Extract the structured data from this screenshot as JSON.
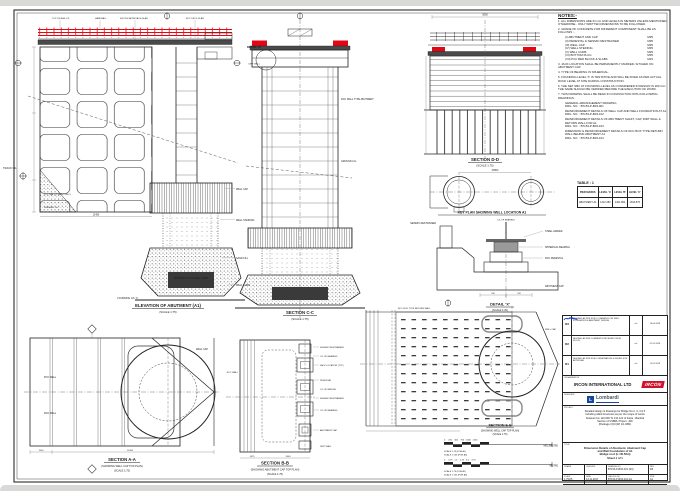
{
  "colors": {
    "accent_red": "#e30613",
    "ircon_red": "#d0112b",
    "lombardi_blue": "#16489c",
    "signature_blue": "#2743c7",
    "line": "#1b1b1b"
  },
  "elevation": {
    "label": "ELEVATION OF ABUTMENT (A1)",
    "scale": "(SCALE 1:75)",
    "top_callouts": [
      "TOP OF RAIL LVL",
      "HANDRAIL",
      "600 THK APPROACH SLAB",
      "RCC DECK SLAB"
    ],
    "side_callouts": [
      "WELL CAP",
      "WELL STEINING",
      "SAND FILL",
      "WELL CURB"
    ],
    "plug_label": "BOTTOM PLUG IN WELL CURB",
    "founding_label": "FOUNDING LVL 'X'",
    "track_label": "TRACK C/L",
    "pcc_label": "PCC WALL (PLAIN CONC.)",
    "fgl_label": "FINISHED G.L.",
    "dim_bottom": "11450"
  },
  "section_c": {
    "label": "SECTION C-C",
    "scale": "(SCALE 1:75)",
    "detail_ref": "DETAIL-'X'",
    "callouts": [
      "RCC WALL TYPE ABUTMENT",
      "GROUND LVL",
      "DIRT WALL"
    ]
  },
  "section_d": {
    "label": "SECTION D-D",
    "scale": "(SCALE 1:75)",
    "dim_top": "5600"
  },
  "key_plan": {
    "label": "KEY PLAN SHOWING WELL LOCATION A1",
    "dim": "40500"
  },
  "detail_x": {
    "label": "DETAIL 'X'",
    "scale": "(SCALE 1:20)",
    "cl": "C/L OF BEARING",
    "girder": "STEEL GIRDER",
    "bearing": "SPHERICAL BEARING",
    "restrainer": "SEISMIC RESTRAINER",
    "pedestal": "RCC PEDESTAL",
    "cap": "ABUTMENT CAP",
    "dims": [
      "700",
      "700"
    ]
  },
  "notes": {
    "title": "NOTES:-",
    "n1": "1.  ALL DIMENSIONS ARE IN mm AND LEVELS IN METERS UNLESS MENTIONED OTHERWISE - ONLY WRITTEN DIMENSIONS TO BE FOLLOWED.",
    "n2": "2.  GRADE OF CONCRETE FOR DIFFERENT COMPONENT SHALL BE AS FOLLOWS :-",
    "grades": [
      [
        "(I) ABUTMENT AND CAP",
        "M35"
      ],
      [
        "(II) PEDESTAL & SEISMIC RESTRAINER",
        "M35"
      ],
      [
        "(III) WELL CAP",
        "M35"
      ],
      [
        "(IV) WELL STEINING",
        "M35"
      ],
      [
        "(V) WELL CURB",
        "M35"
      ],
      [
        "(VI) BOTTOM PLUG",
        "M35"
      ],
      [
        "(VII) PCC BED BLOCK & SLABS",
        "M15"
      ]
    ],
    "n3": "3.  JACK LOCATION SHALL BE PERMANENTLY MARKED / ETCHED ON ABUTMENT CAP.",
    "n4": "4.  TYPE OF BEARING IS SPHERICAL.",
    "n5": "5.  FOUNDING LEVEL 'X' IS TENTATIVE AND WILL BE FIXED AS PER ACTUAL ROCK LEVEL AT SITE DURING CONSTRUCTION.",
    "n6": "6.  THE NET SBC AT FOUNDING LEVEL AS CONSIDERED IN DESIGN IS 200 t/m². THE SAME SHOULD BE VERIFIED BEFORE THE EXECUTION OF WORK.",
    "n7": "7.  THIS DRAWING SHALL BE READ IN CONJUNCTION WITH FOLLOWING DRAWINGS:",
    "refs": [
      [
        "GENERAL ARRANGEMENT DRAWING",
        "DRG. NO. : B7153-P-B03-001"
      ],
      [
        "REINFORCEMENT DETAILS OF WELL CAP AND WELL FOUNDATION AT A1",
        "DRG. NO. : B7153-P-B03-102"
      ],
      [
        "REINFORCEMENT DETAILS OF ABUTMENT SHAFT, CAP, DIRT WALL & RETURN WALL FOR A1",
        "DRG. NO. : B7153-P-B03-103"
      ],
      [
        "DIMENSION & REINFORCEMENT DETAILS OF RCC BOX TYPE RETURN WALL BEHIND ABUTMENT A1",
        "DRG. NO. : B7153-P-B03-104"
      ]
    ]
  },
  "table1": {
    "caption": "TABLE : 1",
    "headers": [
      "PIER MARKS",
      "LEVEL 'A'",
      "LEVEL 'B'",
      "LEVEL 'C'"
    ],
    "rows": [
      [
        "ABUTMENT-A1",
        "1412.280",
        "1401.864",
        "1394.875"
      ]
    ]
  },
  "plan_a": {
    "label": "SECTION A-A",
    "sub": "(SHOWING WELL CAP TOP PLAN)",
    "scale": "(SCALE 1:75)",
    "callouts": [
      "PCC WALL",
      "RCC WALL",
      "WELL CAP"
    ],
    "dims": [
      "1500",
      "11450"
    ]
  },
  "plan_b": {
    "label": "SECTION B-B",
    "sub": "(SHOWING ABUTMENT CAP TOP PLAN)",
    "scale": "(SCALE 1:75)",
    "callouts": [
      "SEISMIC RESTRAINER",
      "C/L OF BEARING",
      "JACK LOCATION (TYP)",
      "PEDESTAL",
      "C/L OF BRIDGE",
      "SEISMIC RESTRAINER",
      "C/L OF BEARING",
      "ABUTMENT CAP",
      "DIRT WALL"
    ],
    "left_callout": "RCC WALL",
    "dims": [
      "1475",
      "2600"
    ]
  },
  "plan_e": {
    "label": "SECTION E-E",
    "sub": "(SHOWING WELL CAP TOP PLAN)",
    "scale": "(SCALE 1:75)",
    "callouts": [
      "RCC BOX TYPE RETURN WALL",
      "WELL CAP"
    ]
  },
  "scale_bars": {
    "bar1_numbers": "0     250    500    750   1000   1250",
    "bar1_unit": "MILLIMETRE",
    "bar2_numbers": "0     0.75   1.5    2.25   3.0    3.75",
    "bar2_unit": "METRE",
    "note1": "SCALE 1:75 (FOR A1)",
    "note2": "SCALE 1:150 (FOR A3)"
  },
  "revisions": {
    "rows": [
      {
        "rev": "R3",
        "desc": "REVISED AS PER RDSO COMMENTS ON WELL FOUNDATION & ABUTMENT DESIGN",
        "sign": "sd/-",
        "date": "16.04.2018"
      },
      {
        "rev": "R2",
        "desc": "REVISED AS PER COMMENTS RECEIVED FROM IRCON",
        "sign": "sd/-",
        "date": "07.02.2018"
      },
      {
        "rev": "R1",
        "desc": "REVISED AS PER RDSO OBSERVATION & ISSUED FOR APPROVAL",
        "sign": "sd/-",
        "date": "11.01.2018"
      }
    ]
  },
  "title_block": {
    "org_label": "ORGANISATION",
    "org": "IRCON INTERNATIONAL LTD",
    "org_logo": "IRCON",
    "designer_label": "DESIGNER",
    "designer": "Lombardi",
    "designer_mark": "L",
    "project_label": "PROJECT",
    "project_lines": [
      "Detailed design & Drawings for Bridge No.2, 3, 4 & 5",
      "including allied structures as per the scope of works",
      "between km 110.000 To 131.121 of Katra - Banihal",
      "Section of USBRL Project, J&K",
      "(Package (O)C(W) 1/1-NB1)"
    ],
    "title_label": "TITLE",
    "title_lines": [
      "Dimension Details of Abutment, Abutment Cap",
      "and Well Foundation of A1",
      "Bridge no.3 (L=40.50m)",
      "Sheet 1 of 1"
    ],
    "fields": {
      "drawn_label": "DRAWN",
      "checked_label": "CHECKED",
      "drgno_label": "DRAWING NO.",
      "drgno": "B7153-P-B03-101 (S0)",
      "rev_label": "REV",
      "rev": "R3",
      "scale_label": "SCALE",
      "scale": "1:75/25",
      "cadfile_label": "CAD FILE NO.",
      "cadfile": "B7153-P-B03-101-A1",
      "date_label": "DATE",
      "date": "13.11.2017",
      "size_label": "SIZE",
      "size": "A1"
    }
  }
}
